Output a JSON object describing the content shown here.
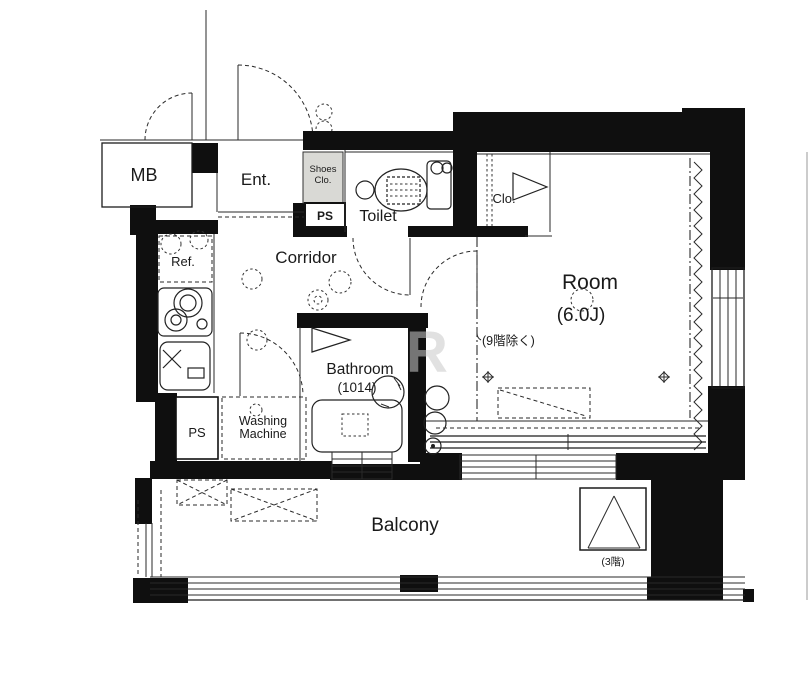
{
  "title": "apartment-floor-plan",
  "colors": {
    "line": "#1c1c1c",
    "wall": "#0f0f0f",
    "background": "#ffffff",
    "watermark": "#c9c9c9",
    "shoes_closet_fill": "#d9d9d5"
  },
  "plan": {
    "meter_box": "MB",
    "entrance": "Ent.",
    "shoes_closet_line1": "Shoes",
    "shoes_closet_line2": "Clo.",
    "pipe_space_upper": "PS",
    "toilet": "Toilet",
    "closet": "Clo.",
    "corridor": "Corridor",
    "refrigerator": "Ref.",
    "main_room": "Room",
    "main_room_size": "(6.0J)",
    "main_room_note": "(9階除く)",
    "bathroom": "Bathroom",
    "bathroom_size": "(1014)",
    "washing_machine_line1": "Washing",
    "washing_machine_line2": "Machine",
    "pipe_space_lower": "PS",
    "balcony": "Balcony",
    "evacuation_hatch_note": "(3階)",
    "watermark": "R"
  }
}
